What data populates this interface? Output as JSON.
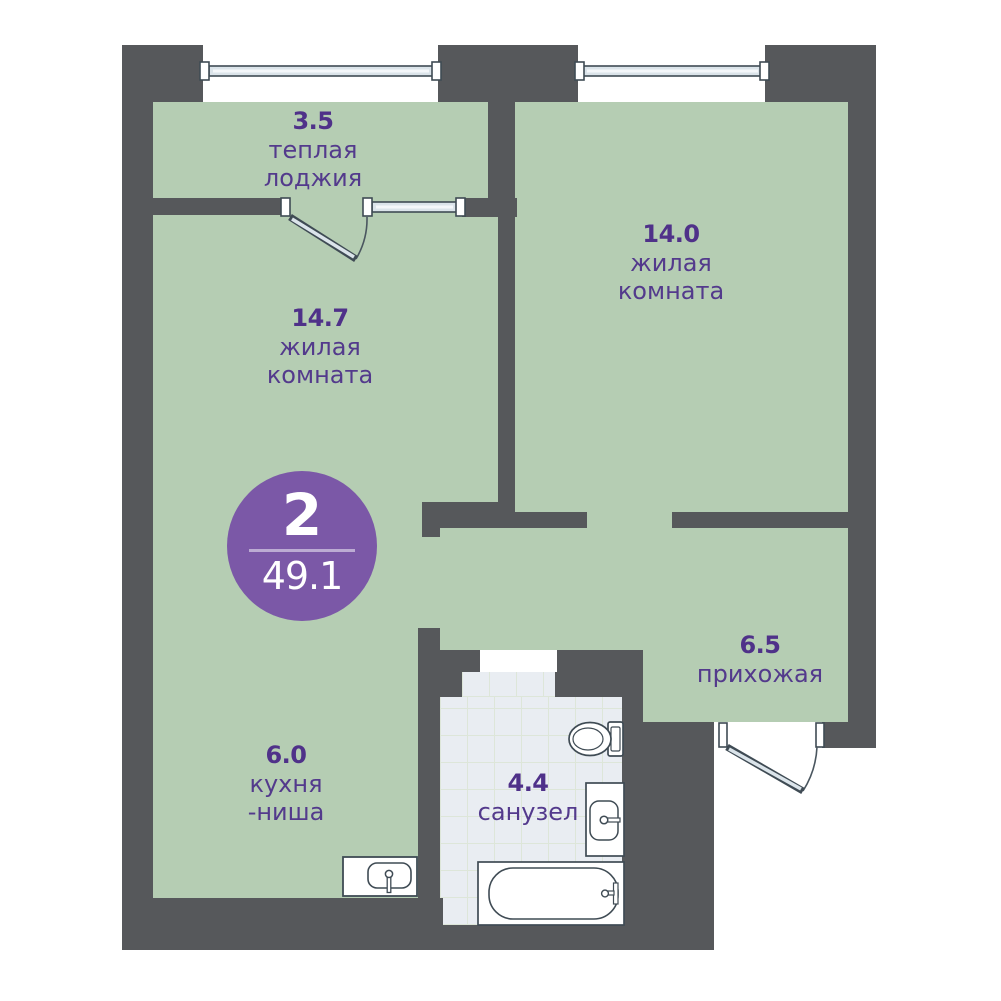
{
  "plan": {
    "badge": {
      "rooms_count": "2",
      "total_area": "49.1"
    },
    "rooms": [
      {
        "id": "loggia",
        "area": "3.5",
        "line1": "теплая",
        "line2": "лоджия"
      },
      {
        "id": "living-1",
        "area": "14.7",
        "line1": "жилая",
        "line2": "комната"
      },
      {
        "id": "living-2",
        "area": "14.0",
        "line1": "жилая",
        "line2": "комната"
      },
      {
        "id": "hallway",
        "area": "6.5",
        "line1": "прихожая",
        "line2": ""
      },
      {
        "id": "kitchen",
        "area": "6.0",
        "line1": "кухня",
        "line2": "-ниша"
      },
      {
        "id": "bathroom",
        "area": "4.4",
        "line1": "санузел",
        "line2": ""
      }
    ],
    "colors": {
      "wall": "#56585b",
      "floor": "#b5cdb3",
      "tile_floor": "#e9edf2",
      "accent_badge": "#7b58a7",
      "label_text": "#533a8c",
      "fixture_stroke": "#3f4b54",
      "glazing_fill": "#dbe4ea"
    }
  }
}
